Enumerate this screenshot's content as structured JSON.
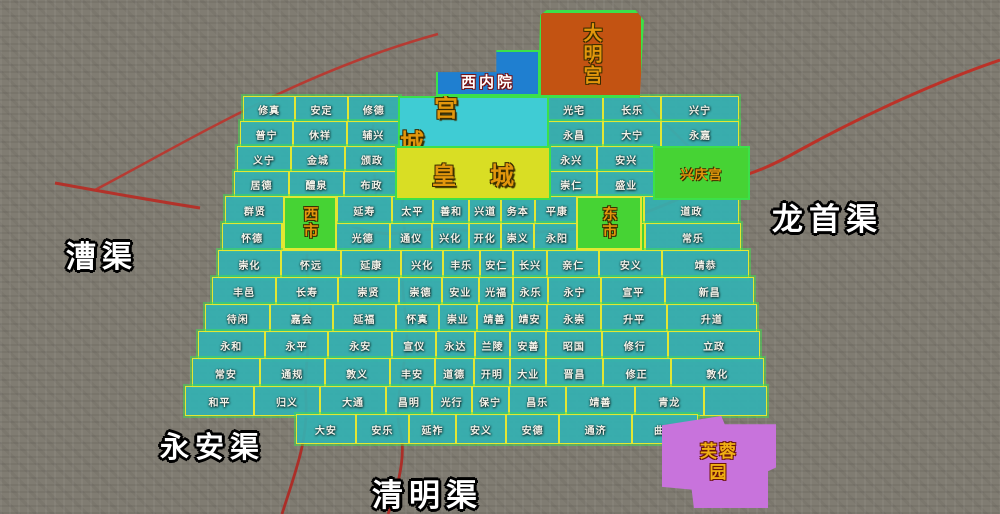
{
  "map": {
    "areas": {
      "daminggong": "大明宫",
      "xineiyuan": "西内院",
      "gongcheng": "宫城",
      "huangcheng": "皇城",
      "xingqinggong": "兴庆宫",
      "west_market": "西市",
      "east_market": "东市",
      "furongyuan": "芙蓉园"
    },
    "canals": {
      "caoqu": "漕渠",
      "longshouqu": "龙首渠",
      "yonganqu": "永安渠",
      "qingmingqu": "清明渠"
    },
    "ward_rows": [
      [
        "修真",
        "安定",
        "修德"
      ],
      [
        "光宅",
        "长乐",
        "兴宁"
      ],
      [
        "普宁",
        "休祥",
        "辅兴"
      ],
      [
        "永昌",
        "大宁",
        "永嘉"
      ],
      [
        "义宁",
        "金城",
        "颁政"
      ],
      [
        "永兴",
        "安兴"
      ],
      [
        "居德",
        "醴泉",
        "布政"
      ],
      [
        "崇仁",
        "盛业"
      ],
      [
        "群贤",
        "",
        "延寿",
        "太平",
        "善和",
        "兴道",
        "务本",
        "平康",
        "",
        "道政"
      ],
      [
        "怀德",
        "",
        "光德",
        "通仪",
        "兴化",
        "开化",
        "崇义",
        "永阳",
        "",
        "常乐"
      ],
      [
        "崇化",
        "怀远",
        "延康",
        "兴化",
        "丰乐",
        "安仁",
        "长兴",
        "亲仁",
        "安义",
        "靖恭"
      ],
      [
        "丰邑",
        "长寿",
        "崇贤",
        "崇德",
        "安业",
        "光福",
        "永乐",
        "永宁",
        "宣平",
        "新昌"
      ],
      [
        "待闲",
        "嘉会",
        "延福",
        "怀真",
        "崇业",
        "靖善",
        "靖安",
        "永崇",
        "升平",
        "升道"
      ],
      [
        "永和",
        "永平",
        "永安",
        "宣仪",
        "永达",
        "兰陵",
        "安善",
        "昭国",
        "修行",
        "立政"
      ],
      [
        "常安",
        "通规",
        "敦义",
        "丰安",
        "道德",
        "开明",
        "大业",
        "晋昌",
        "修正",
        "敦化"
      ],
      [
        "和平",
        "归义",
        "大通",
        "昌明",
        "光行",
        "保宁",
        "昌乐",
        "靖善",
        "青龙",
        ""
      ],
      [
        "大安",
        "安乐",
        "延祚",
        "安义",
        "安德",
        "通济",
        "曲池"
      ]
    ],
    "colors": {
      "ward_fill": "#34b0b2",
      "grid_line": "#e3e733",
      "outline_green": "#3ce04a",
      "market_green": "#46d334",
      "palace_orange": "#c35312",
      "imperial_yellow": "#d9de24",
      "palace_cyan": "#3fccd4",
      "xineiyuan_blue": "#1f7fd0",
      "furong_purple": "#c873dc",
      "canal_red": "#c22a20",
      "label_white": "#ffffff",
      "area_text_orange": "#e2960c"
    }
  }
}
